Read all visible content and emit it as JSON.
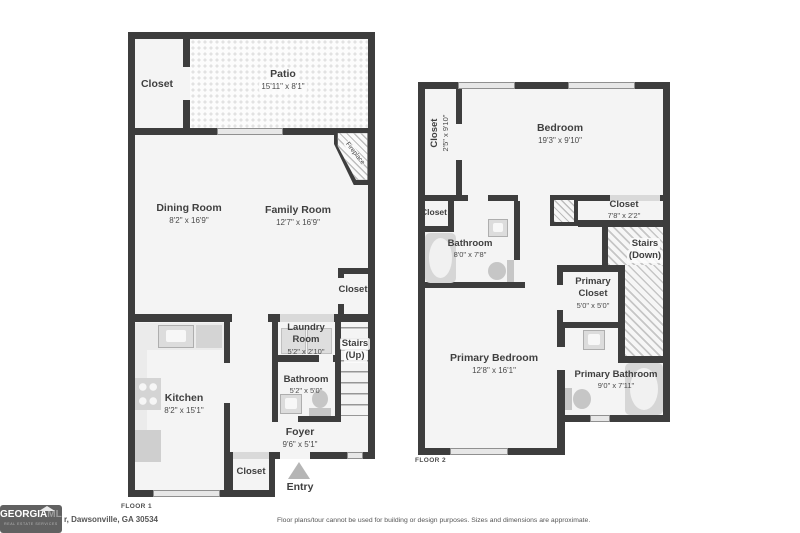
{
  "floor1": {
    "label": "FLOOR 1",
    "closet_tl": {
      "name": "Closet"
    },
    "patio": {
      "name": "Patio",
      "dims": "15'11\" x 8'1\""
    },
    "fireplace": {
      "name": "Fireplace"
    },
    "dining": {
      "name": "Dining Room",
      "dims": "8'2\" x 16'9\""
    },
    "family": {
      "name": "Family Room",
      "dims": "12'7\" x 16'9\""
    },
    "closet_right": {
      "name": "Closet"
    },
    "kitchen": {
      "name": "Kitchen",
      "dims": "8'2\" x 15'1\""
    },
    "laundry": {
      "name": "Laundry",
      "name2": "Room",
      "dims": "5'2\" x 2'10\""
    },
    "stairs": {
      "name": "Stairs",
      "dims": "(Up)"
    },
    "bathroom": {
      "name": "Bathroom",
      "dims": "5'2\" x 5'0\""
    },
    "foyer": {
      "name": "Foyer",
      "dims": "9'6\" x 5'1\""
    },
    "closet_bottom": {
      "name": "Closet"
    },
    "entry": {
      "name": "Entry"
    }
  },
  "floor2": {
    "label": "FLOOR 2",
    "closet_side": {
      "name": "Closet",
      "dims": "2'5\" x 9'10\""
    },
    "bedroom": {
      "name": "Bedroom",
      "dims": "19'3\" x 9'10\""
    },
    "closet_small": {
      "name": "Closet"
    },
    "closet_top": {
      "name": "Closet",
      "dims": "7'8\" x 2'2\""
    },
    "bathroom": {
      "name": "Bathroom",
      "dims": "8'0\" x 7'8\""
    },
    "stairs": {
      "name": "Stairs",
      "dims": "(Down)"
    },
    "primary_closet": {
      "name": "Primary",
      "name2": "Closet",
      "dims": "5'0\" x 5'0\""
    },
    "primary_bedroom": {
      "name": "Primary Bedroom",
      "dims": "12'8\" x 16'1\""
    },
    "primary_bathroom": {
      "name": "Primary Bathroom",
      "dims": "9'0\" x 7'11\""
    }
  },
  "footer": {
    "logo_text1": "GEORGIA",
    "logo_text2": "MLS",
    "logo_tagline": "REAL ESTATE SERVICES",
    "address": "r, Dawsonville, GA 30534",
    "disclaimer": "Floor plans/tour cannot be used for building or design purposes. Sizes and dimensions are approximate."
  },
  "colors": {
    "wall": "#3d3d3d",
    "floor": "#f4f4f4",
    "fixture": "#d4d4d4",
    "text": "#3f3f3f"
  }
}
